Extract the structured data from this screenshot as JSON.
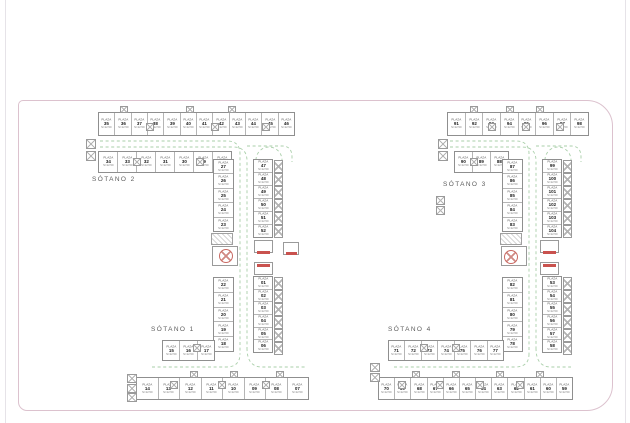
{
  "page": {
    "background": "#ffffff",
    "sheet_border_color": "#dcc2ce",
    "wall_color": "#8f8f8f",
    "lane_color": "#a9cfa9",
    "accent_red": "#c9524e"
  },
  "stall": {
    "prefix": "PLAZA",
    "area_label": "S=12.50"
  },
  "floors": [
    {
      "id": "sotano-2",
      "label": "SÓTANO 2",
      "strips": [
        {
          "x": 98,
          "y": 112,
          "w": 197,
          "h": 24,
          "dir": "h",
          "labels": [
            "35",
            "36",
            "37",
            "38",
            "39",
            "40",
            "41",
            "42",
            "43",
            "44",
            "45",
            "46"
          ]
        },
        {
          "x": 98,
          "y": 151,
          "w": 134,
          "h": 22,
          "dir": "h",
          "labels": [
            "34",
            "33",
            "32",
            "31",
            "30",
            "29",
            "28"
          ]
        },
        {
          "x": 213,
          "y": 159,
          "w": 21,
          "h": 73,
          "dir": "v",
          "labels": [
            "27",
            "26",
            "25",
            "24",
            "23"
          ]
        },
        {
          "x": 253,
          "y": 159,
          "w": 20,
          "h": 79,
          "dir": "v",
          "labels": [
            "47",
            "48",
            "49",
            "50",
            "51",
            "52"
          ]
        }
      ]
    },
    {
      "id": "sotano-1",
      "label": "SÓTANO 1",
      "strips": [
        {
          "x": 213,
          "y": 277,
          "w": 21,
          "h": 75,
          "dir": "v",
          "labels": [
            "22",
            "21",
            "20",
            "19",
            "18"
          ]
        },
        {
          "x": 253,
          "y": 276,
          "w": 20,
          "h": 77,
          "dir": "v",
          "labels": [
            "01",
            "02",
            "03",
            "04",
            "05",
            "06"
          ]
        },
        {
          "x": 162,
          "y": 340,
          "w": 53,
          "h": 21,
          "dir": "h",
          "labels": [
            "15",
            "16",
            "17"
          ]
        },
        {
          "x": 136,
          "y": 377,
          "w": 173,
          "h": 23,
          "dir": "h",
          "labels": [
            "14",
            "13",
            "12",
            "11",
            "10",
            "09",
            "08",
            "07"
          ]
        }
      ]
    },
    {
      "id": "sotano-3",
      "label": "SÓTANO 3",
      "strips": [
        {
          "x": 447,
          "y": 112,
          "w": 142,
          "h": 24,
          "dir": "h",
          "labels": [
            "91",
            "92",
            "93",
            "94",
            "95",
            "96",
            "97",
            "98"
          ]
        },
        {
          "x": 454,
          "y": 151,
          "w": 55,
          "h": 22,
          "dir": "h",
          "labels": [
            "90",
            "89",
            "88"
          ]
        },
        {
          "x": 502,
          "y": 159,
          "w": 21,
          "h": 73,
          "dir": "v",
          "labels": [
            "87",
            "86",
            "85",
            "84",
            "83"
          ]
        },
        {
          "x": 542,
          "y": 159,
          "w": 20,
          "h": 79,
          "dir": "v",
          "labels": [
            "99",
            "100",
            "101",
            "102",
            "103",
            "104"
          ]
        }
      ]
    },
    {
      "id": "sotano-4",
      "label": "SÓTANO 4",
      "strips": [
        {
          "x": 502,
          "y": 277,
          "w": 21,
          "h": 75,
          "dir": "v",
          "labels": [
            "82",
            "81",
            "80",
            "79",
            "78"
          ]
        },
        {
          "x": 542,
          "y": 276,
          "w": 20,
          "h": 77,
          "dir": "v",
          "labels": [
            "53",
            "54",
            "55",
            "56",
            "57",
            "58"
          ]
        },
        {
          "x": 388,
          "y": 340,
          "w": 116,
          "h": 21,
          "dir": "h",
          "labels": [
            "71",
            "72",
            "73",
            "74",
            "75",
            "76",
            "77"
          ]
        },
        {
          "x": 378,
          "y": 377,
          "w": 195,
          "h": 23,
          "dir": "h",
          "labels": [
            "70",
            "69",
            "68",
            "67",
            "66",
            "65",
            "64",
            "63",
            "62",
            "61",
            "60",
            "59"
          ]
        }
      ]
    }
  ],
  "decor": {
    "xboxes": [
      {
        "x": 86,
        "y": 139,
        "w": 10,
        "h": 10
      },
      {
        "x": 86,
        "y": 151,
        "w": 10,
        "h": 10
      },
      {
        "x": 120,
        "y": 106,
        "w": 8,
        "h": 7
      },
      {
        "x": 186,
        "y": 106,
        "w": 8,
        "h": 7
      },
      {
        "x": 228,
        "y": 106,
        "w": 8,
        "h": 7
      },
      {
        "x": 146,
        "y": 123,
        "w": 8,
        "h": 8
      },
      {
        "x": 211,
        "y": 123,
        "w": 8,
        "h": 8
      },
      {
        "x": 262,
        "y": 123,
        "w": 8,
        "h": 8
      },
      {
        "x": 133,
        "y": 158,
        "w": 8,
        "h": 8
      },
      {
        "x": 196,
        "y": 158,
        "w": 8,
        "h": 8
      },
      {
        "x": 127,
        "y": 374,
        "w": 10,
        "h": 9
      },
      {
        "x": 127,
        "y": 384,
        "w": 10,
        "h": 9
      },
      {
        "x": 127,
        "y": 393,
        "w": 10,
        "h": 9
      },
      {
        "x": 193,
        "y": 344,
        "w": 8,
        "h": 8
      },
      {
        "x": 190,
        "y": 371,
        "w": 8,
        "h": 7
      },
      {
        "x": 230,
        "y": 371,
        "w": 8,
        "h": 7
      },
      {
        "x": 276,
        "y": 371,
        "w": 8,
        "h": 7
      },
      {
        "x": 170,
        "y": 381,
        "w": 8,
        "h": 8
      },
      {
        "x": 218,
        "y": 381,
        "w": 8,
        "h": 8
      },
      {
        "x": 262,
        "y": 381,
        "w": 8,
        "h": 8
      },
      {
        "x": 438,
        "y": 139,
        "w": 10,
        "h": 10
      },
      {
        "x": 438,
        "y": 151,
        "w": 10,
        "h": 10
      },
      {
        "x": 436,
        "y": 196,
        "w": 9,
        "h": 9
      },
      {
        "x": 436,
        "y": 206,
        "w": 9,
        "h": 9
      },
      {
        "x": 470,
        "y": 106,
        "w": 8,
        "h": 7
      },
      {
        "x": 506,
        "y": 106,
        "w": 8,
        "h": 7
      },
      {
        "x": 536,
        "y": 106,
        "w": 8,
        "h": 7
      },
      {
        "x": 488,
        "y": 123,
        "w": 8,
        "h": 8
      },
      {
        "x": 522,
        "y": 123,
        "w": 8,
        "h": 8
      },
      {
        "x": 556,
        "y": 123,
        "w": 8,
        "h": 8
      },
      {
        "x": 470,
        "y": 158,
        "w": 8,
        "h": 8
      },
      {
        "x": 370,
        "y": 363,
        "w": 10,
        "h": 9
      },
      {
        "x": 370,
        "y": 373,
        "w": 10,
        "h": 9
      },
      {
        "x": 420,
        "y": 344,
        "w": 8,
        "h": 8
      },
      {
        "x": 452,
        "y": 344,
        "w": 8,
        "h": 8
      },
      {
        "x": 412,
        "y": 371,
        "w": 8,
        "h": 7
      },
      {
        "x": 452,
        "y": 371,
        "w": 8,
        "h": 7
      },
      {
        "x": 496,
        "y": 371,
        "w": 8,
        "h": 7
      },
      {
        "x": 536,
        "y": 371,
        "w": 8,
        "h": 7
      },
      {
        "x": 398,
        "y": 381,
        "w": 8,
        "h": 8
      },
      {
        "x": 436,
        "y": 381,
        "w": 8,
        "h": 8
      },
      {
        "x": 476,
        "y": 381,
        "w": 8,
        "h": 8
      },
      {
        "x": 516,
        "y": 381,
        "w": 8,
        "h": 8
      }
    ],
    "box_cols": [
      {
        "x": 274,
        "y": 160,
        "w": 9,
        "cell": 13,
        "n": 6
      },
      {
        "x": 274,
        "y": 277,
        "w": 9,
        "cell": 13,
        "n": 6
      },
      {
        "x": 563,
        "y": 160,
        "w": 9,
        "cell": 13,
        "n": 6
      },
      {
        "x": 563,
        "y": 277,
        "w": 9,
        "cell": 13,
        "n": 6
      }
    ],
    "coreboxes": [
      {
        "x": 254,
        "y": 240,
        "w": 19,
        "h": 13
      },
      {
        "x": 254,
        "y": 262,
        "w": 19,
        "h": 13
      },
      {
        "x": 283,
        "y": 242,
        "w": 16,
        "h": 13
      },
      {
        "x": 212,
        "y": 246,
        "w": 26,
        "h": 20
      },
      {
        "x": 540,
        "y": 240,
        "w": 19,
        "h": 13
      },
      {
        "x": 540,
        "y": 262,
        "w": 19,
        "h": 13
      },
      {
        "x": 501,
        "y": 246,
        "w": 26,
        "h": 20
      }
    ],
    "stripe_boxes": [
      {
        "x": 211,
        "y": 233,
        "w": 22,
        "h": 12
      },
      {
        "x": 500,
        "y": 233,
        "w": 22,
        "h": 12
      }
    ],
    "red_bars": [
      {
        "x": 257,
        "y": 251,
        "w": 13,
        "h": 3
      },
      {
        "x": 257,
        "y": 264,
        "w": 13,
        "h": 3
      },
      {
        "x": 286,
        "y": 252,
        "w": 11,
        "h": 3
      },
      {
        "x": 543,
        "y": 251,
        "w": 13,
        "h": 3
      },
      {
        "x": 543,
        "y": 264,
        "w": 13,
        "h": 3
      }
    ],
    "vents": [
      {
        "cx": 226,
        "cy": 256,
        "r": 7
      },
      {
        "cx": 511,
        "cy": 257,
        "r": 7
      }
    ]
  }
}
